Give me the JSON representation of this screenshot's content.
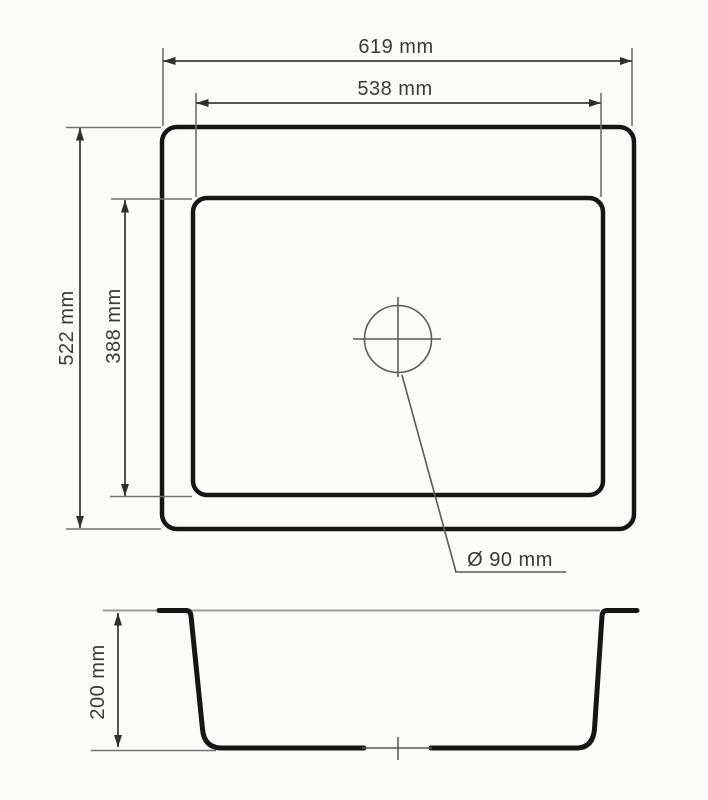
{
  "drawing": {
    "subject": "sink-dimension-drawing",
    "top_view": {
      "outer_width": "619 mm",
      "inner_width": "538 mm",
      "outer_depth": "522 mm",
      "inner_depth": "388 mm",
      "drain_diameter": "Ø 90 mm"
    },
    "section_view": {
      "bowl_depth": "200 mm"
    },
    "colors": {
      "outline": "#161616",
      "dimension_line": "#3f3f3f",
      "extension_line": "#707070",
      "rim_line": "#9a9a9a",
      "text": "#3a3a3a",
      "background": "#fbfbfa"
    }
  }
}
